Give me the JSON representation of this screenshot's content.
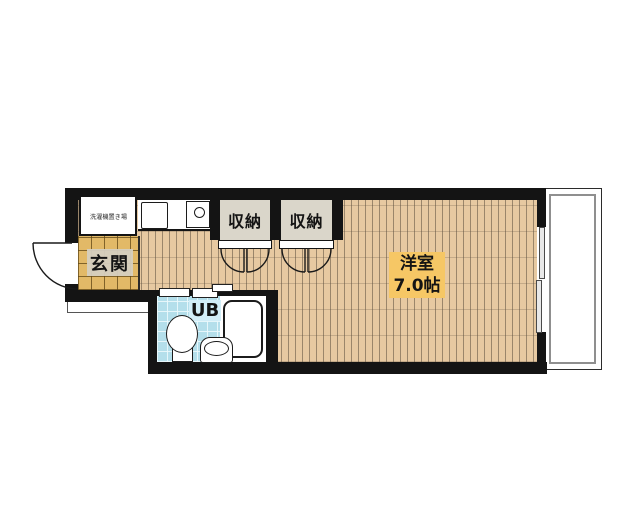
{
  "rooms": {
    "entrance": "玄関",
    "laundry": "洗濯機置き場",
    "closet_left": "収納",
    "closet_right": "収納",
    "main_room_name": "洋室",
    "main_room_size": "7.0帖",
    "unit_bath": "UB"
  },
  "colors": {
    "wall": "#141414",
    "wood_floor": "#e7c9a1",
    "entrance_tile": "#e2b967",
    "closet_fill": "#dad6ca",
    "main_room_label_bg": "#f6c765",
    "bath_tile": "#b4dfeb",
    "bath_label_bg": "#d2eef8",
    "entrance_label_bg": "#d5cfc0"
  }
}
